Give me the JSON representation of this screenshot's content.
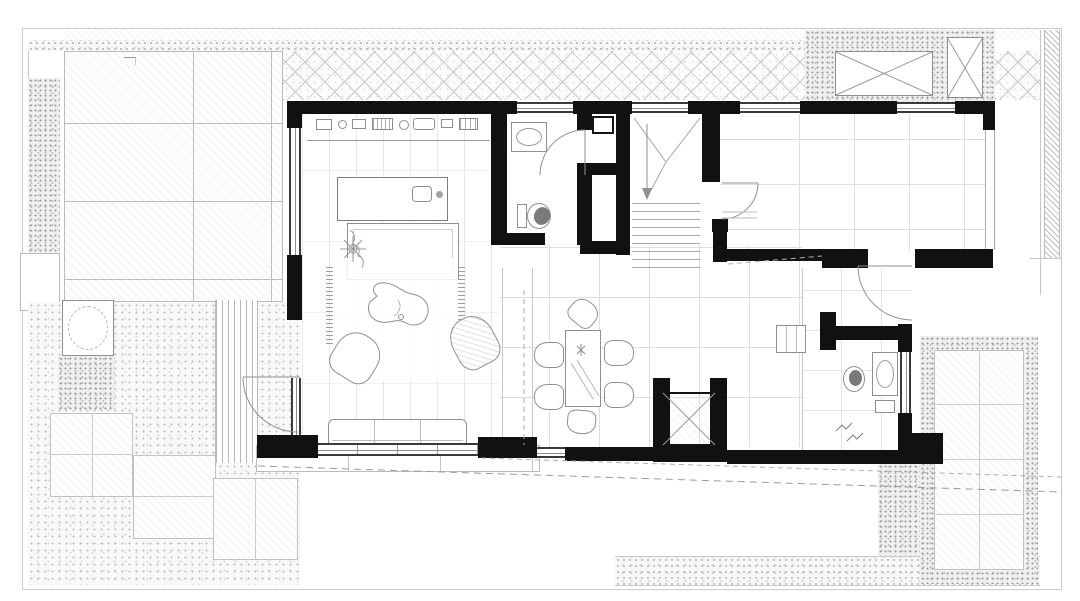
{
  "document": {
    "kind": "architectural floor plan drawing",
    "style": "monochrome CAD ground-floor plan: solid black walls, gray linework, stippled landscape textures",
    "visible_text": []
  },
  "colors": {
    "paper": "#ffffff",
    "wall": "#111111",
    "line_dark": "#3a3a3a",
    "line": "#8f8f8f",
    "line_light": "#c6c6c6",
    "fixture_gray": "#7a7a7a"
  },
  "outdoor": {
    "features": [
      "tiled-patio-with-diagonal-hatch",
      "pebble-border-strips",
      "diamond-lattice-paved-court",
      "two-x-marked-skylight-grates",
      "gravel-garden",
      "stepping-pavers",
      "square-tree-planter-with-circle",
      "timber-deck-strips-at-entry",
      "exterior-step-band",
      "rear-paver-yard-with-pebble-frame",
      "hatched-boundary-wall-right",
      "dashed-setback-lines-bottom"
    ],
    "stepping_paver_count": 3,
    "skylight_count": 2
  },
  "building": {
    "rooms": [
      "kitchen-living-room",
      "powder-room",
      "utility-shaft",
      "stair-hall",
      "large-right-room",
      "dining-area",
      "elevator",
      "rear-bathroom"
    ],
    "door_swing_count": 4,
    "stair": {
      "flights": 1,
      "tread_lines": 9,
      "direction_arrow": "down"
    },
    "elevator": {
      "cab_marked_with_x": true
    }
  },
  "furniture": {
    "kitchen_counter_appliance_marks": 8,
    "kitchen_island": 1,
    "island_sink": 1,
    "daybed_with_blanket": 1,
    "fringed_rug": 1,
    "kidney_coffee_table": 1,
    "armchair": 1,
    "woven_lounge_chair": 1,
    "plant": 1,
    "sofa": 1,
    "dining_table": 1,
    "dining_chairs": 6,
    "toilets": 2,
    "sinks": 3,
    "washer": 1
  }
}
